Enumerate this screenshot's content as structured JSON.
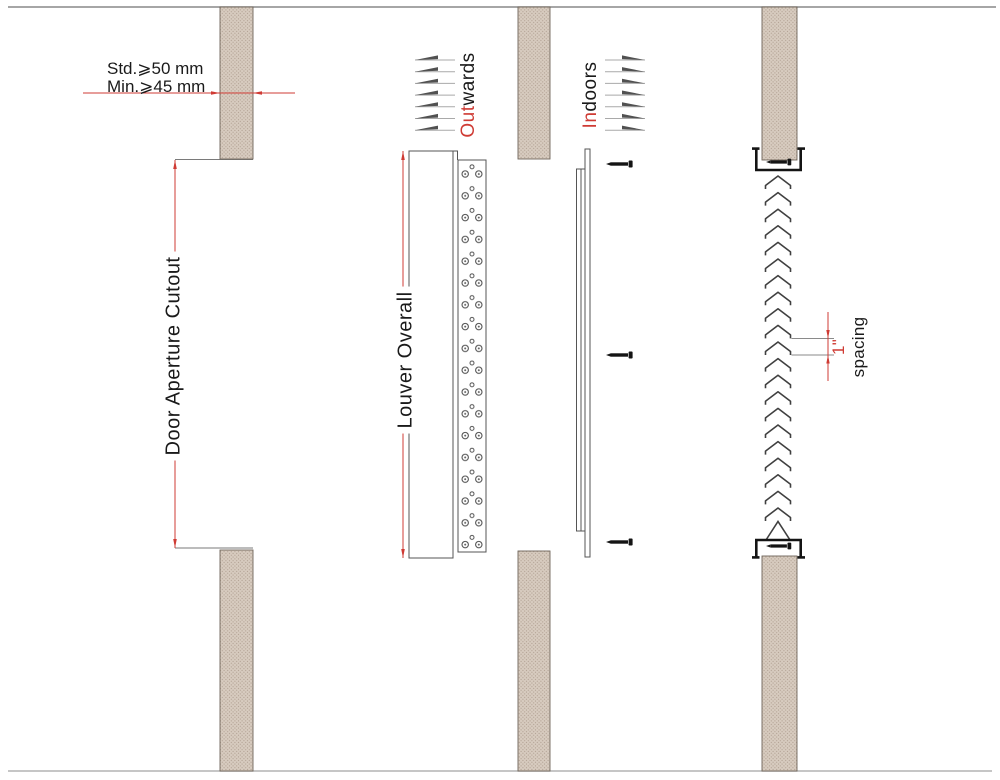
{
  "drawing_title": "Door louver installation detail",
  "labels": {
    "door_thickness_std": "Std.⩾50 mm",
    "door_thickness_min": "Min.⩾45 mm",
    "door_aperture_cutout": "Door Aperture Cutout",
    "louver_overall": "Louver Overall",
    "outwards_prefix": "Out",
    "outwards_suffix": "wards",
    "indoors_prefix": "In",
    "indoors_suffix": "doors",
    "spacing_value": "1\"",
    "spacing_word": "spacing"
  },
  "colors": {
    "dimension_red": "#cf3b34",
    "door_panel_fill": "#d8ccc0",
    "door_panel_texture": "#b3a294",
    "outline_gray": "#555555",
    "extension_gray": "#8a8a8a",
    "hardware_black": "#141414",
    "blade_gray": "#404040",
    "border_line": "#888888"
  }
}
